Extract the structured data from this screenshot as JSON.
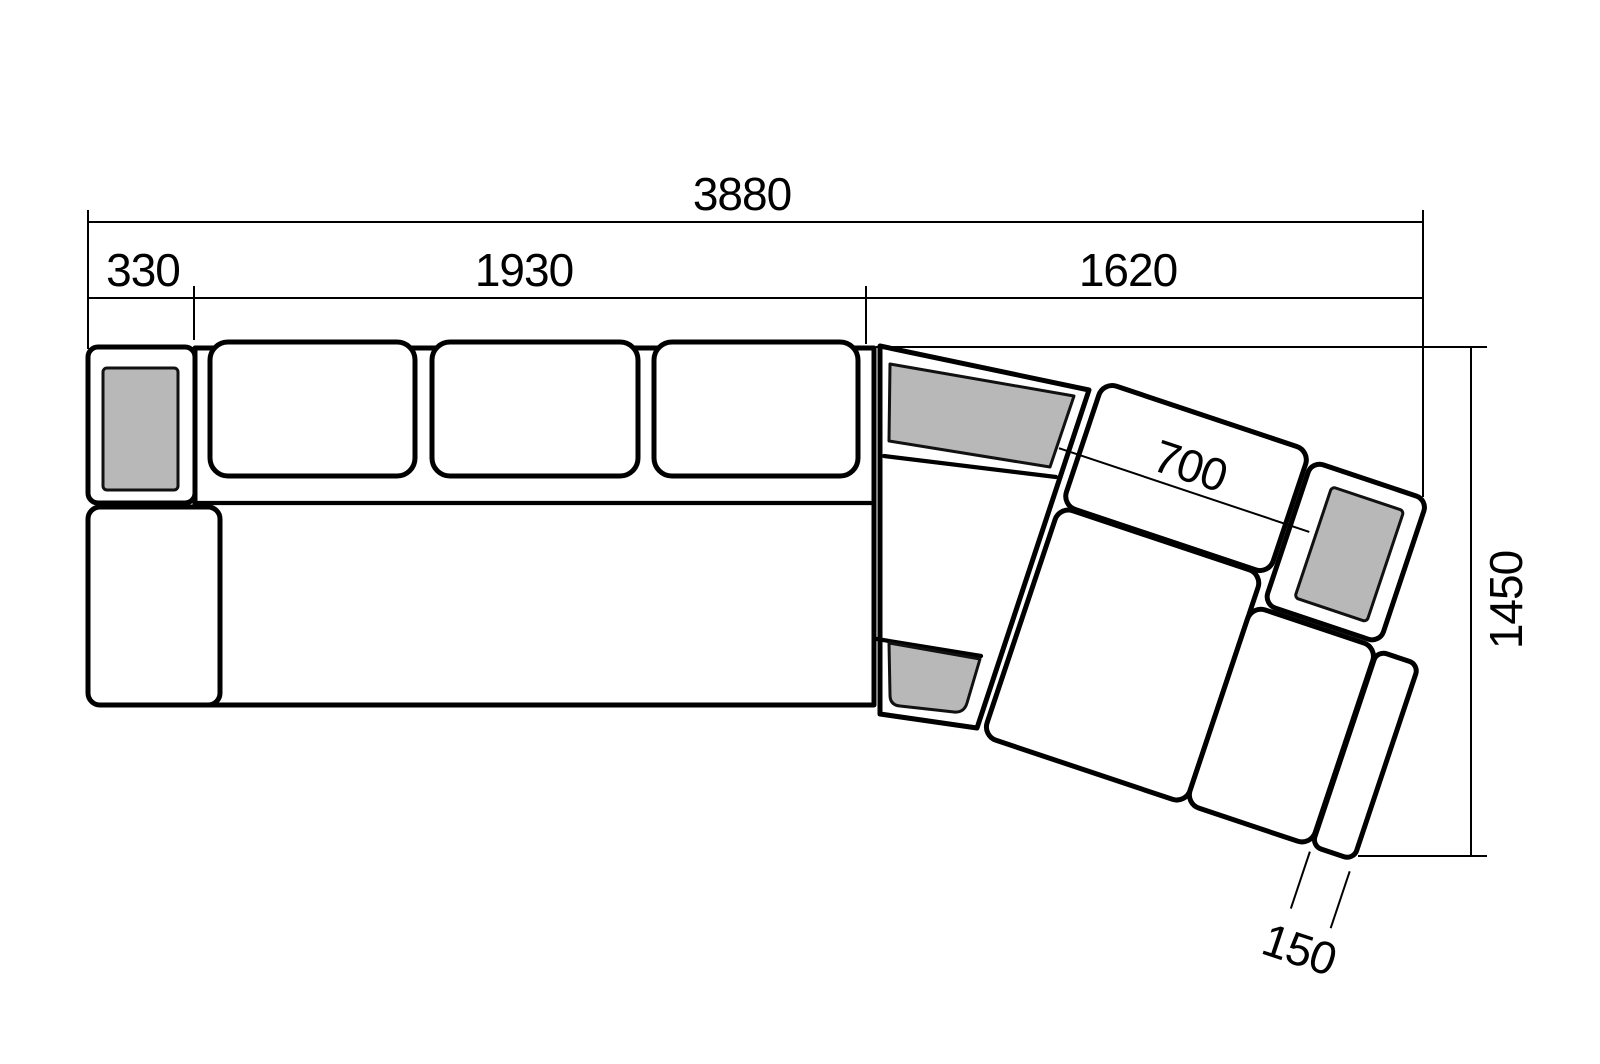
{
  "meta": {
    "type": "furniture technical drawing",
    "subject": "corner sectional sofa, plan view with dimensions in mm"
  },
  "colors": {
    "background": "#ffffff",
    "line": "#000000",
    "panel_fill": "#b8b8b8"
  },
  "dims": {
    "total_length": "3880",
    "armrest_width": "330",
    "straight_section_length": "1930",
    "angled_section_length": "1620",
    "back_cushion_width": "700",
    "overall_depth": "1450",
    "end_strip_width": "150"
  }
}
